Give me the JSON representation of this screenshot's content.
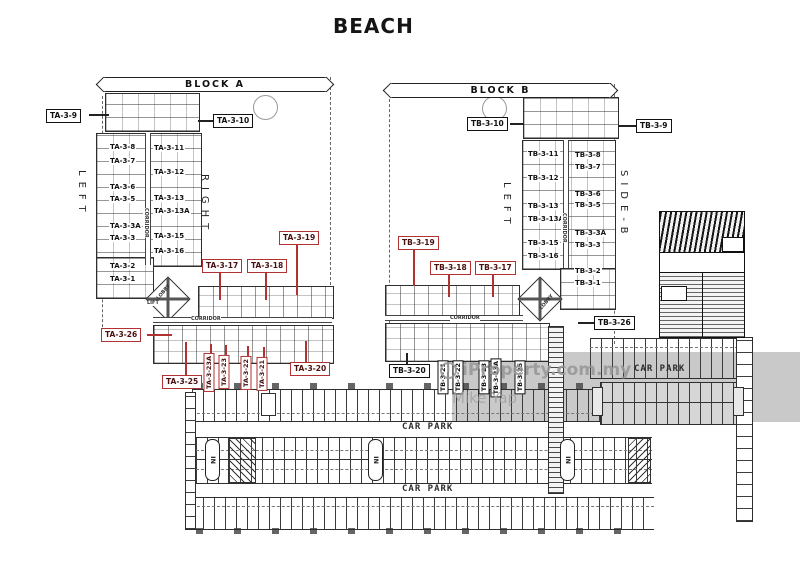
{
  "title": "BEACH",
  "watermark": {
    "icon": "info-circle-icon",
    "icon_letter": "i",
    "brand": "iProperty.com.my",
    "user": "Mike Yap"
  },
  "texts": {
    "corridor": "CORRIDOR",
    "lobby": "LOBBY",
    "lift": "LIFT"
  },
  "car_park": {
    "label": "CAR PARK",
    "in_marker": "IN"
  },
  "colors": {
    "highlight_red": "#b03232",
    "line": "#2e2e2e",
    "gray_band": "#c9c9c9",
    "watermark_gray": "#969696"
  },
  "blocks": {
    "a": {
      "banner": "BLOCK A",
      "side_left": "LEFT",
      "side_right": "RIGHT",
      "labels": [
        {
          "id": "ta-3-9",
          "text": "TA-3-9",
          "style": "boxed"
        },
        {
          "id": "ta-3-10",
          "text": "TA-3-10",
          "style": "boxed"
        },
        {
          "id": "ta-3-8",
          "text": "TA-3-8",
          "style": "plain"
        },
        {
          "id": "ta-3-11",
          "text": "TA-3-11",
          "style": "plain"
        },
        {
          "id": "ta-3-7",
          "text": "TA-3-7",
          "style": "plain"
        },
        {
          "id": "ta-3-12",
          "text": "TA-3-12",
          "style": "plain"
        },
        {
          "id": "ta-3-6",
          "text": "TA-3-6",
          "style": "plain"
        },
        {
          "id": "ta-3-5",
          "text": "TA-3-5",
          "style": "plain"
        },
        {
          "id": "ta-3-13",
          "text": "TA-3-13",
          "style": "plain"
        },
        {
          "id": "ta-3-13a",
          "text": "TA-3-13A",
          "style": "plain"
        },
        {
          "id": "ta-3-3a",
          "text": "TA-3-3A",
          "style": "plain"
        },
        {
          "id": "ta-3-15",
          "text": "TA-3-15",
          "style": "plain"
        },
        {
          "id": "ta-3-3",
          "text": "TA-3-3",
          "style": "plain"
        },
        {
          "id": "ta-3-16",
          "text": "TA-3-16",
          "style": "plain"
        },
        {
          "id": "ta-3-2",
          "text": "TA-3-2",
          "style": "plain"
        },
        {
          "id": "ta-3-1",
          "text": "TA-3-1",
          "style": "plain"
        },
        {
          "id": "ta-3-19",
          "text": "TA-3-19",
          "style": "red"
        },
        {
          "id": "ta-3-17",
          "text": "TA-3-17",
          "style": "red"
        },
        {
          "id": "ta-3-18",
          "text": "TA-3-18",
          "style": "red"
        },
        {
          "id": "ta-3-26",
          "text": "TA-3-26",
          "style": "red"
        },
        {
          "id": "ta-3-25",
          "text": "TA-3-25",
          "style": "red"
        },
        {
          "id": "ta-3-23a",
          "text": "TA-3-23A",
          "style": "red-vertical"
        },
        {
          "id": "ta-3-23",
          "text": "TA-3-23",
          "style": "red-vertical"
        },
        {
          "id": "ta-3-22",
          "text": "TA-3-22",
          "style": "red-vertical"
        },
        {
          "id": "ta-3-21",
          "text": "TA-3-21",
          "style": "red-vertical"
        },
        {
          "id": "ta-3-20",
          "text": "TA-3-20",
          "style": "red"
        }
      ]
    },
    "b": {
      "banner": "BLOCK B",
      "side_left": "LEFT",
      "side_right": "SIDE-B",
      "labels": [
        {
          "id": "tb-3-10",
          "text": "TB-3-10",
          "style": "boxed"
        },
        {
          "id": "tb-3-9",
          "text": "TB-3-9",
          "style": "boxed"
        },
        {
          "id": "tb-3-11",
          "text": "TB-3-11",
          "style": "plain"
        },
        {
          "id": "tb-3-8",
          "text": "TB-3-8",
          "style": "plain"
        },
        {
          "id": "tb-3-7",
          "text": "TB-3-7",
          "style": "plain"
        },
        {
          "id": "tb-3-12",
          "text": "TB-3-12",
          "style": "plain"
        },
        {
          "id": "tb-3-6",
          "text": "TB-3-6",
          "style": "plain"
        },
        {
          "id": "tb-3-13",
          "text": "TB-3-13",
          "style": "plain"
        },
        {
          "id": "tb-3-5",
          "text": "TB-3-5",
          "style": "plain"
        },
        {
          "id": "tb-3-13a",
          "text": "TB-3-13A",
          "style": "plain"
        },
        {
          "id": "tb-3-3a",
          "text": "TB-3-3A",
          "style": "plain"
        },
        {
          "id": "tb-3-15",
          "text": "TB-3-15",
          "style": "plain"
        },
        {
          "id": "tb-3-3",
          "text": "TB-3-3",
          "style": "plain"
        },
        {
          "id": "tb-3-16",
          "text": "TB-3-16",
          "style": "plain"
        },
        {
          "id": "tb-3-2",
          "text": "TB-3-2",
          "style": "plain"
        },
        {
          "id": "tb-3-1",
          "text": "TB-3-1",
          "style": "plain"
        },
        {
          "id": "tb-3-19",
          "text": "TB-3-19",
          "style": "red"
        },
        {
          "id": "tb-3-18",
          "text": "TB-3-18",
          "style": "red"
        },
        {
          "id": "tb-3-17",
          "text": "TB-3-17",
          "style": "red"
        },
        {
          "id": "tb-3-26",
          "text": "TB-3-26",
          "style": "boxed"
        },
        {
          "id": "tb-3-20",
          "text": "TB-3-20",
          "style": "boxed"
        },
        {
          "id": "tb-3-21",
          "text": "TB-3-21",
          "style": "boxed-vertical"
        },
        {
          "id": "tb-3-22",
          "text": "TB-3-22",
          "style": "boxed-vertical"
        },
        {
          "id": "tb-3-23",
          "text": "TB-3-23",
          "style": "boxed-vertical"
        },
        {
          "id": "tb-3-23a",
          "text": "TB-3-23A",
          "style": "boxed-vertical"
        },
        {
          "id": "tb-3-25",
          "text": "TB-3-25",
          "style": "boxed-vertical"
        }
      ]
    }
  }
}
